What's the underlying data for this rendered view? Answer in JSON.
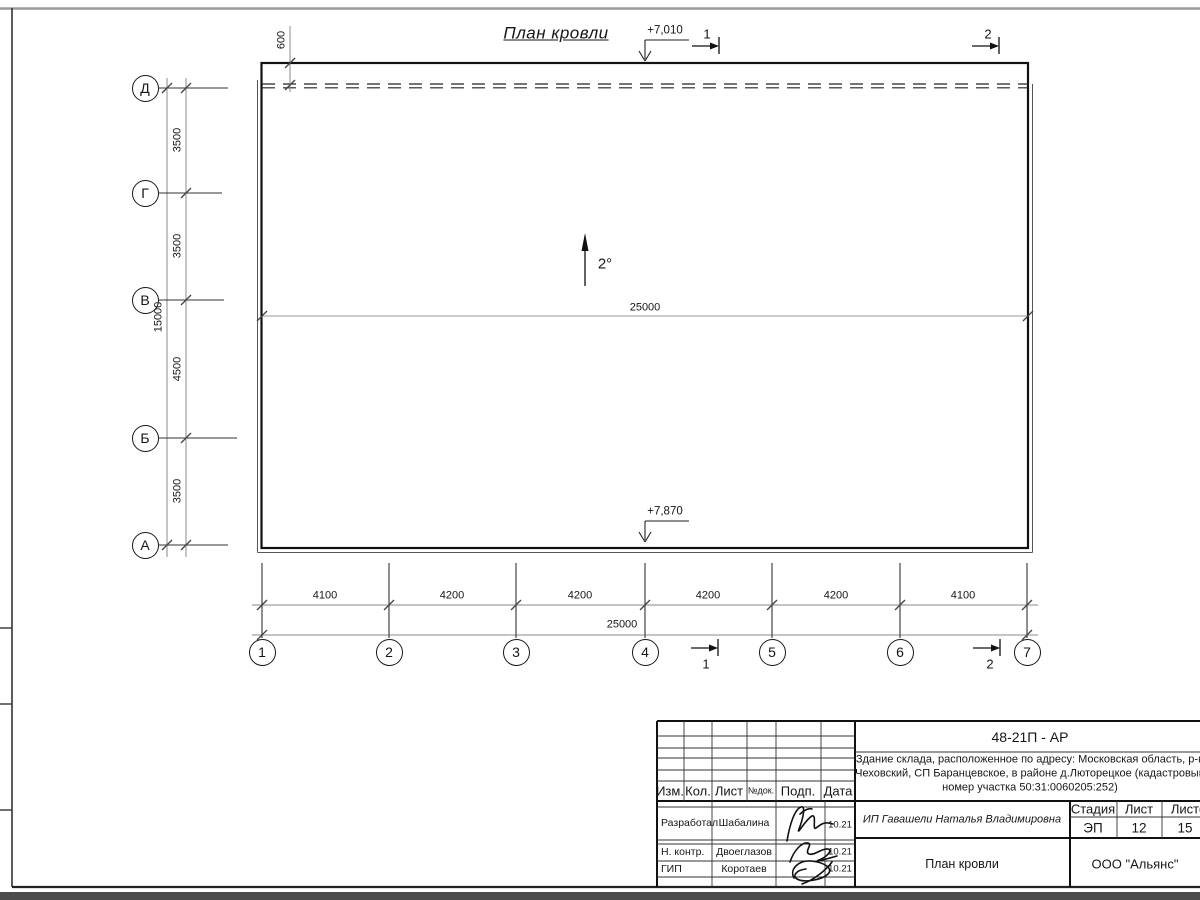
{
  "colors": {
    "paper": "#ffffff",
    "line": "#161616",
    "dim_line": "#777777"
  },
  "drawing": {
    "title": "План кровли",
    "slope": "2°",
    "roof_overhang": "600",
    "elevation_top": "+7,010",
    "elevation_bottom": "+7,870",
    "ridge_length": "25000",
    "section_1": "1",
    "section_2": "2"
  },
  "axes": {
    "rows": [
      "Д",
      "Г",
      "В",
      "Б",
      "А"
    ],
    "row_spans": [
      "3500",
      "3500",
      "4500",
      "3500"
    ],
    "rows_total": "15000",
    "cols": [
      "1",
      "2",
      "3",
      "4",
      "5",
      "6",
      "7"
    ],
    "col_spans": [
      "4100",
      "4200",
      "4200",
      "4200",
      "4200",
      "4100"
    ],
    "cols_total": "25000"
  },
  "titleblock": {
    "doc_number": "48-21П - АР",
    "project_lines": [
      "Здание склада, расположенное по адресу: Московская область, р-н",
      "Чеховский, СП Баранцевское, в районе д.Люторецкое  (кадастровый",
      "номер участка 50:31:0060205:252)"
    ],
    "header_cols": [
      "Изм.",
      "Кол.",
      "Лист",
      "№док.",
      "Подп.",
      "Дата"
    ],
    "signoff": [
      {
        "role": "Разработал",
        "name": "Шабалина",
        "date": "10.21"
      },
      {
        "role": "Н. контр.",
        "name": "Двоеглазов",
        "date": "10.21"
      },
      {
        "role": "ГИП",
        "name": "Коротаев",
        "date": "10.21"
      }
    ],
    "client": "ИП Гавашели Наталья Владимировна",
    "stage_label": "Стадия",
    "sheet_label": "Лист",
    "sheets_label": "Листов",
    "stage": "ЭП",
    "sheet_no": "12",
    "sheets_total": "15",
    "drawing_name": "План кровли",
    "company": "ООО \"Альянс\""
  }
}
